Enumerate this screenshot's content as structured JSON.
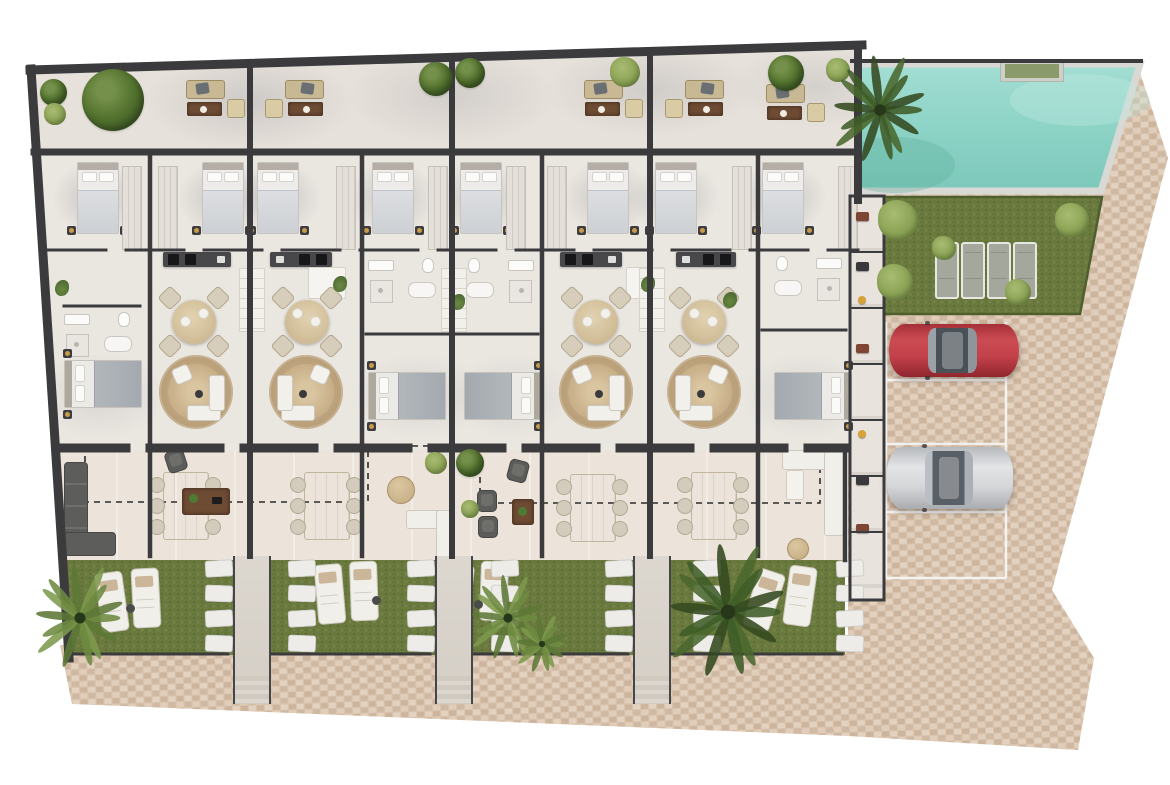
{
  "meta": {
    "kind": "architectural-site-plan-render",
    "description": "top-down 3d floor plan of a row of eight townhouse units with roof terraces, gardens, communal pool, lawn and parking"
  },
  "canvas": {
    "w": 1170,
    "h": 785,
    "background": "#ffffff"
  },
  "palette": {
    "wall": "#3b3b3e",
    "floor_interior": "#eae6e0",
    "floor_roof": "#e6e1da",
    "floor_terrace": "#ece4da",
    "grass": "#6b7a3e",
    "grass_dark": "#5d6f35",
    "grass_light": "#77854a",
    "grass_edge": "#4e5e2d",
    "pool_light": "#9edbd0",
    "pool_deep": "#7fcabc",
    "pool_rim": "#d8d8d4",
    "cobble": "#d8c3ae",
    "cobble_dark": "#cdb49c",
    "cobble_light": "#e3d2c0",
    "walkway": "#d8d3ca",
    "rug": "#ccb48e",
    "wood": "#6e4b33",
    "sofa_beige": "#c8b894",
    "sofa_dark": "#5d5d5b",
    "white_furniture": "#f1efe9",
    "car_red": "#c2414a",
    "car_silver": "#d5d6d8",
    "dashed_line": "#2b2b2b",
    "parking_line": "#f6f6f4",
    "gold_lamp": "#c89a4b",
    "item_red": "#7e4434",
    "item_yellow": "#d8a23a"
  },
  "site": {
    "building": {
      "units": 8,
      "mirrored_pairs": [
        [
          1,
          2
        ],
        [
          3,
          4
        ],
        [
          5,
          6
        ],
        [
          7,
          8
        ]
      ],
      "rows": [
        "roof-terrace",
        "bedroom-row",
        "kitchen-bath-row",
        "living-dining-row",
        "rear-terraces",
        "private-gardens"
      ],
      "outline": [
        [
          30,
          70
        ],
        [
          862,
          45
        ],
        [
          858,
          600
        ],
        [
          69,
          658
        ]
      ]
    },
    "walls": {
      "outer_top": "M30,70 L862,45",
      "outer_left": "M31,69 L69,658",
      "outer_right": "M858,45 L858,200",
      "roof_row": "M34,152 H858",
      "mid_row": "M48,250 H858",
      "south": "M56,448 H845",
      "bay_walls": "M150,156 V556 M362,156 V556 M542,156 V556 M758,156 V556 M845,448 V560",
      "pair_walls": "M250,64 V556 M452,58 V556 M650,53 V556",
      "bath_walls": "M64,306 H140 M366,334 H448 M456,334 H538 M762,330 H846",
      "fence": "M70,654 H228 M272,654 H430 M474,654 H628 M672,654 H842",
      "storage_outline": "M850,196 H884 V600 H850 Z",
      "storage_dividers": "M850,252 H884 M850,308 H884 M850,364 H884 M850,420 H884 M850,476 H884 M850,532 H884",
      "pool_top": "M852,61 H1141"
    },
    "pool": {
      "path": "M858,64 L1140,64 L1101,191 L858,191 Z",
      "rim_width": 7
    },
    "lawn": {
      "path": "M884,197 L1102,197 L1080,314 L884,314 Z",
      "sun_loungers": 4
    },
    "gardens": {
      "path": "M62,558 L845,558 L845,655 L69,655 Z",
      "sections": 4,
      "loungers_per_section": 2
    },
    "paving": {
      "right_path": "M858,190 L1101,190 L1136,60 L1168,158 L1096,428 L1052,590 L1094,658 L1078,750 L848,736 L848,190 Z",
      "bottom_path": "M60,645 L848,645 L848,736 L72,704 Z"
    },
    "parking": {
      "lines_path": "M886,380 H1006 M886,444 H1006 M886,512 H1006 M886,578 H1006 M1006,322 V578 M886,322 V578",
      "spots": [
        {
          "index": 1,
          "occupied": true,
          "car": "red"
        },
        {
          "index": 2,
          "occupied": false
        },
        {
          "index": 3,
          "occupied": true,
          "car": "silver"
        },
        {
          "index": 4,
          "occupied": false
        }
      ]
    },
    "boundary_dashed_path": "M85,445 V502 H368 V446 H480 V503 H820 V447 H845",
    "storage_strip": {
      "rooms": 7
    }
  },
  "objects": [
    {
      "t": "tree",
      "x": 53,
      "y": 92,
      "d": 27
    },
    {
      "t": "tree",
      "x": 113,
      "y": 100,
      "d": 62
    },
    {
      "t": "bush",
      "x": 55,
      "y": 114,
      "d": 22
    },
    {
      "t": "sofa-set",
      "x": 186,
      "y": 80
    },
    {
      "t": "sofa-set",
      "x": 266,
      "y": 80,
      "m": 1
    },
    {
      "t": "tree",
      "x": 436,
      "y": 79,
      "d": 34
    },
    {
      "t": "tree",
      "x": 470,
      "y": 73,
      "d": 30
    },
    {
      "t": "sofa-set",
      "x": 584,
      "y": 80
    },
    {
      "t": "sofa-set",
      "x": 666,
      "y": 80,
      "m": 1
    },
    {
      "t": "bush",
      "x": 625,
      "y": 72,
      "d": 30
    },
    {
      "t": "tree",
      "x": 786,
      "y": 73,
      "d": 36
    },
    {
      "t": "bush",
      "x": 838,
      "y": 70,
      "d": 24
    },
    {
      "t": "sofa-set",
      "x": 766,
      "y": 84
    },
    {
      "t": "bed-v",
      "x": 77,
      "y": 162
    },
    {
      "t": "bed-v",
      "x": 202,
      "y": 162
    },
    {
      "t": "bed-v",
      "x": 257,
      "y": 162
    },
    {
      "t": "bed-v",
      "x": 372,
      "y": 162
    },
    {
      "t": "bed-v",
      "x": 460,
      "y": 162
    },
    {
      "t": "bed-v",
      "x": 587,
      "y": 162
    },
    {
      "t": "bed-v",
      "x": 655,
      "y": 162
    },
    {
      "t": "bed-v",
      "x": 762,
      "y": 162
    },
    {
      "t": "wardrobe",
      "x": 122,
      "y": 166
    },
    {
      "t": "wardrobe",
      "x": 158,
      "y": 166
    },
    {
      "t": "wardrobe",
      "x": 336,
      "y": 166
    },
    {
      "t": "wardrobe",
      "x": 428,
      "y": 166
    },
    {
      "t": "wardrobe",
      "x": 506,
      "y": 166
    },
    {
      "t": "wardrobe",
      "x": 547,
      "y": 166
    },
    {
      "t": "wardrobe",
      "x": 732,
      "y": 166
    },
    {
      "t": "wardrobe",
      "x": 838,
      "y": 166
    },
    {
      "t": "counter",
      "x": 163,
      "y": 252,
      "w": 68
    },
    {
      "t": "counter",
      "x": 270,
      "y": 252,
      "w": 62,
      "m": 1
    },
    {
      "t": "counter",
      "x": 560,
      "y": 252,
      "w": 62
    },
    {
      "t": "counter",
      "x": 676,
      "y": 252,
      "w": 60,
      "m": 1
    },
    {
      "t": "island",
      "x": 308,
      "y": 267
    },
    {
      "t": "island",
      "x": 626,
      "y": 267
    },
    {
      "t": "hall",
      "x": 239,
      "y": 268
    },
    {
      "t": "hall",
      "x": 441,
      "y": 268
    },
    {
      "t": "hall",
      "x": 639,
      "y": 268
    },
    {
      "t": "bath",
      "x": 64,
      "y": 312
    },
    {
      "t": "bath",
      "x": 368,
      "y": 258
    },
    {
      "t": "bath",
      "x": 462,
      "y": 258,
      "m": 1
    },
    {
      "t": "bath",
      "x": 770,
      "y": 256,
      "m": 1
    },
    {
      "t": "round-dining",
      "x": 194,
      "y": 322
    },
    {
      "t": "round-dining",
      "x": 307,
      "y": 322,
      "m": 1
    },
    {
      "t": "round-dining",
      "x": 596,
      "y": 322
    },
    {
      "t": "round-dining",
      "x": 704,
      "y": 322,
      "m": 1
    },
    {
      "t": "rug-lounge",
      "x": 196,
      "y": 392
    },
    {
      "t": "rug-lounge",
      "x": 306,
      "y": 392,
      "m": 1
    },
    {
      "t": "rug-lounge",
      "x": 596,
      "y": 392
    },
    {
      "t": "rug-lounge",
      "x": 704,
      "y": 392,
      "m": 1
    },
    {
      "t": "bed-h",
      "x": 64,
      "y": 360
    },
    {
      "t": "bed-h",
      "x": 368,
      "y": 372
    },
    {
      "t": "bed-h",
      "x": 464,
      "y": 372,
      "m": 1
    },
    {
      "t": "bed-h",
      "x": 774,
      "y": 372,
      "m": 1
    },
    {
      "t": "sprig",
      "x": 62,
      "y": 288
    },
    {
      "t": "sprig",
      "x": 340,
      "y": 284
    },
    {
      "t": "sprig",
      "x": 648,
      "y": 284
    },
    {
      "t": "sprig",
      "x": 458,
      "y": 302
    },
    {
      "t": "sprig",
      "x": 730,
      "y": 300
    },
    {
      "t": "dining6",
      "x": 185,
      "y": 505
    },
    {
      "t": "dining6",
      "x": 326,
      "y": 505
    },
    {
      "t": "dining6",
      "x": 592,
      "y": 507
    },
    {
      "t": "dining6",
      "x": 713,
      "y": 505
    },
    {
      "t": "l-sofa-dark",
      "x": 64,
      "y": 462
    },
    {
      "t": "armchair-dark",
      "x": 166,
      "y": 450,
      "rot": -18
    },
    {
      "t": "coffee-table",
      "x": 182,
      "y": 488
    },
    {
      "t": "armchair-dark",
      "x": 508,
      "y": 460,
      "rot": 15
    },
    {
      "t": "armchair-dark",
      "x": 477,
      "y": 490
    },
    {
      "t": "armchair-dark",
      "x": 478,
      "y": 516
    },
    {
      "t": "coffee-table",
      "x": 512,
      "y": 499,
      "s": 1
    },
    {
      "t": "l-sofa-white",
      "x": 406,
      "y": 510
    },
    {
      "t": "l-sofa-white",
      "x": 782,
      "y": 450,
      "big": 1
    },
    {
      "t": "pouf",
      "x": 400,
      "y": 489,
      "d": 26
    },
    {
      "t": "pouf",
      "x": 797,
      "y": 548,
      "d": 20
    },
    {
      "t": "bush",
      "x": 436,
      "y": 463,
      "d": 22
    },
    {
      "t": "tree",
      "x": 470,
      "y": 463,
      "d": 28
    },
    {
      "t": "bush",
      "x": 470,
      "y": 509,
      "d": 18
    },
    {
      "t": "lounger",
      "x": 98,
      "y": 572,
      "rot": -8
    },
    {
      "t": "lounger",
      "x": 132,
      "y": 568,
      "rot": -3
    },
    {
      "t": "lounger",
      "x": 316,
      "y": 564,
      "rot": -5
    },
    {
      "t": "lounger",
      "x": 350,
      "y": 561,
      "rot": -2
    },
    {
      "t": "lounger",
      "x": 444,
      "y": 564,
      "rot": 6
    },
    {
      "t": "lounger",
      "x": 480,
      "y": 561,
      "rot": 2
    },
    {
      "t": "lounger",
      "x": 750,
      "y": 570,
      "rot": 18
    },
    {
      "t": "lounger",
      "x": 786,
      "y": 566,
      "rot": 8
    },
    {
      "t": "side-table",
      "x": 126,
      "y": 604
    },
    {
      "t": "side-table",
      "x": 372,
      "y": 596
    },
    {
      "t": "side-table",
      "x": 474,
      "y": 600
    },
    {
      "t": "stones",
      "x": 205,
      "y": 560
    },
    {
      "t": "stones",
      "x": 288,
      "y": 560
    },
    {
      "t": "stones",
      "x": 407,
      "y": 560
    },
    {
      "t": "stones",
      "x": 491,
      "y": 560
    },
    {
      "t": "stones",
      "x": 605,
      "y": 560
    },
    {
      "t": "stones",
      "x": 693,
      "y": 560
    },
    {
      "t": "stones",
      "x": 836,
      "y": 560
    },
    {
      "t": "walkway",
      "x": 233,
      "y": 556
    },
    {
      "t": "walkway",
      "x": 435,
      "y": 556
    },
    {
      "t": "walkway",
      "x": 633,
      "y": 556
    },
    {
      "t": "palm",
      "x": 80,
      "y": 618,
      "r": 46,
      "v": "light"
    },
    {
      "t": "palm",
      "x": 508,
      "y": 618,
      "r": 38,
      "v": "light"
    },
    {
      "t": "palm",
      "x": 542,
      "y": 644,
      "r": 26,
      "v": "light"
    },
    {
      "t": "palm",
      "x": 728,
      "y": 612,
      "r": 60,
      "v": "dark"
    },
    {
      "t": "palm",
      "x": 880,
      "y": 110,
      "r": 48,
      "v": "dark"
    },
    {
      "t": "bush",
      "x": 898,
      "y": 220,
      "d": 40
    },
    {
      "t": "bush",
      "x": 1072,
      "y": 220,
      "d": 34
    },
    {
      "t": "bush",
      "x": 944,
      "y": 248,
      "d": 24
    },
    {
      "t": "bush",
      "x": 895,
      "y": 282,
      "d": 36
    },
    {
      "t": "bush",
      "x": 1018,
      "y": 292,
      "d": 26
    },
    {
      "t": "lounger-gray",
      "x": 935,
      "y": 242
    },
    {
      "t": "lounger-gray",
      "x": 961,
      "y": 242
    },
    {
      "t": "lounger-gray",
      "x": 987,
      "y": 242
    },
    {
      "t": "lounger-gray",
      "x": 1013,
      "y": 242
    },
    {
      "t": "pool-ledge",
      "x": 1000,
      "y": 60
    },
    {
      "t": "item",
      "x": 856,
      "y": 212,
      "c": "red"
    },
    {
      "t": "item",
      "x": 856,
      "y": 262,
      "c": "dark"
    },
    {
      "t": "item",
      "x": 858,
      "y": 296,
      "c": "yellow"
    },
    {
      "t": "item",
      "x": 856,
      "y": 344,
      "c": "red"
    },
    {
      "t": "item",
      "x": 858,
      "y": 430,
      "c": "yellow"
    },
    {
      "t": "item",
      "x": 856,
      "y": 476,
      "c": "dark"
    },
    {
      "t": "item",
      "x": 856,
      "y": 524,
      "c": "red"
    },
    {
      "t": "car",
      "x": 889,
      "y": 324,
      "w": 130,
      "h": 53,
      "color": "red"
    },
    {
      "t": "car",
      "x": 887,
      "y": 447,
      "w": 126,
      "h": 62,
      "color": "silver"
    }
  ]
}
